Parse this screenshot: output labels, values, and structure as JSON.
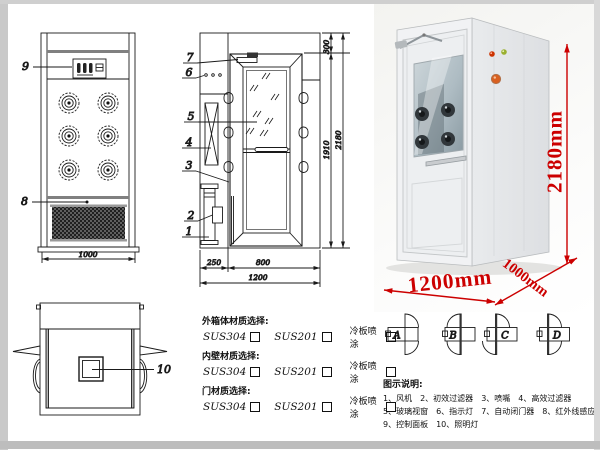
{
  "drawing": {
    "front_view": {
      "callout_9": "9",
      "callout_8": "8",
      "dim_width": "1000"
    },
    "side_view": {
      "callout_7": "7",
      "callout_6": "6",
      "callout_5": "5",
      "callout_4": "4",
      "callout_3": "3",
      "callout_2": "2",
      "callout_1": "1",
      "dim_left": "250",
      "dim_door": "800",
      "dim_total_width": "1200",
      "dim_top": "300",
      "dim_door_height": "1910",
      "dim_total_height": "2180"
    },
    "top_view": {
      "callout_10": "10"
    }
  },
  "photo": {
    "height_label": "2180mm",
    "width_label": "1200mm",
    "depth_label": "1000mm",
    "dimension_color": "#cc0000"
  },
  "materials": {
    "sections": [
      {
        "title": "外箱体材质选择:",
        "options": [
          "SUS304",
          "SUS201",
          "冷板喷涂"
        ]
      },
      {
        "title": "内壁材质选择:",
        "options": [
          "SUS304",
          "SUS201",
          "冷板喷涂"
        ]
      },
      {
        "title": "门材质选择:",
        "options": [
          "SUS304",
          "SUS201",
          "冷板喷涂"
        ]
      }
    ]
  },
  "door_configs": {
    "labels": [
      "A",
      "B",
      "C",
      "D"
    ]
  },
  "legend": {
    "title": "图示说明:",
    "items": [
      [
        "1、风机",
        "2、初效过滤器",
        "3、喷嘴",
        "4、高效过滤器"
      ],
      [
        "5、玻璃视窗",
        "6、指示灯",
        "7、自动闭门器",
        "8、红外线感应器"
      ],
      [
        "9、控制面板",
        "10、照明灯"
      ]
    ]
  }
}
